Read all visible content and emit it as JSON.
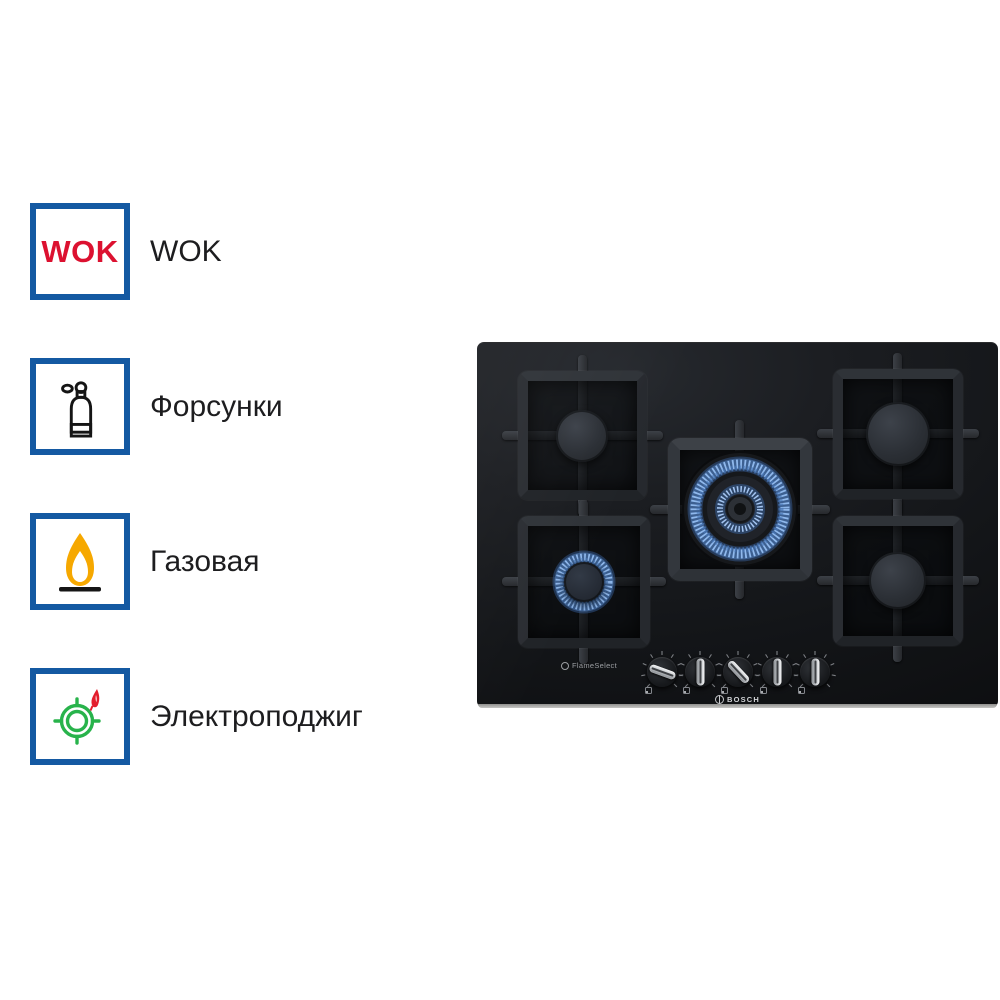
{
  "features": [
    {
      "label": "WOK",
      "badge_text": "WOK",
      "icon": "wok-badge-icon"
    },
    {
      "label": "Форсунки",
      "icon": "gas-cylinder-icon"
    },
    {
      "label": "Газовая",
      "icon": "gas-flame-icon"
    },
    {
      "label": "Электроподжиг",
      "icon": "electric-ignition-icon"
    }
  ],
  "hob": {
    "brand": "BOSCH",
    "badge": "FlameSelect",
    "burners": [
      {
        "position": "top-left",
        "size": "medium",
        "lit": false
      },
      {
        "position": "top-right",
        "size": "large",
        "lit": false
      },
      {
        "position": "center",
        "size": "wok-dual-ring",
        "lit": true
      },
      {
        "position": "bottom-left",
        "size": "small",
        "lit": true
      },
      {
        "position": "bottom-right",
        "size": "medium",
        "lit": false
      }
    ],
    "knobs": [
      {
        "rotation_deg": 20
      },
      {
        "rotation_deg": 90
      },
      {
        "rotation_deg": 47
      },
      {
        "rotation_deg": 90
      },
      {
        "rotation_deg": 90
      }
    ]
  },
  "colors": {
    "accent_blue": "#1459a2",
    "wok_red": "#dc1130",
    "flame_orange": "#f6a800",
    "ignition_green": "#28b34b",
    "ignition_red": "#e31e2d",
    "burner_flame_blue": "#8fb8ec",
    "glass_black": "#131518"
  }
}
